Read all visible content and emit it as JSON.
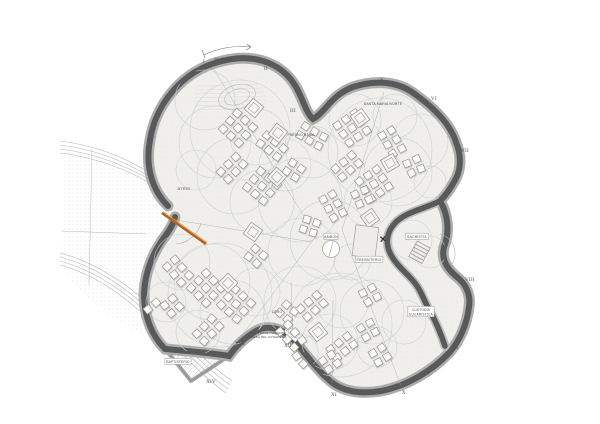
{
  "drawing": {
    "type": "architectural-floor-plan",
    "description": "Clover-shaped church / assembly hall plan with Via Crucis stations I-XIV around the perimeter",
    "colors": {
      "wall": "#58595b",
      "halo": "#adadab",
      "interior": "#f0efeb",
      "zone_circle": "#c9d0d6",
      "thin_line": "#a7afb5",
      "chair_fill": "#fbfaf7",
      "chair_stroke": "#96968e",
      "ramp": "#b5601a",
      "text": "#4a4a4a",
      "plaza_line": "#b5b5b2",
      "stipple": "#c9c8c3",
      "hatch": "#c6c5c1"
    }
  },
  "annotations": {
    "via_crucis": "VIA CRUCIS"
  },
  "stations": [
    {
      "label": "I",
      "x": 204,
      "y": 63
    },
    {
      "label": "II",
      "x": 266,
      "y": 70
    },
    {
      "label": "III",
      "x": 293,
      "y": 112
    },
    {
      "label": "IV",
      "x": 330,
      "y": 104
    },
    {
      "label": "V",
      "x": 382,
      "y": 81
    },
    {
      "label": "VI",
      "x": 434,
      "y": 100
    },
    {
      "label": "VII",
      "x": 465,
      "y": 152
    },
    {
      "label": "VIII",
      "x": 470,
      "y": 281
    },
    {
      "label": "IX",
      "x": 456,
      "y": 349
    },
    {
      "label": "X",
      "x": 404,
      "y": 394
    },
    {
      "label": "XI",
      "x": 334,
      "y": 396
    },
    {
      "label": "XII",
      "x": 288,
      "y": 347
    },
    {
      "label": "XIII",
      "x": 240,
      "y": 345
    },
    {
      "label": "XIV",
      "x": 211,
      "y": 383
    }
  ],
  "rooms": [
    {
      "id": "atrio",
      "lines": [
        "ATRIO"
      ],
      "x": 184,
      "y": 190,
      "boxed": false,
      "anchor": "middle",
      "size": 4
    },
    {
      "id": "fresno-rama",
      "lines": [
        "FRESNO RAMA"
      ],
      "x": 301,
      "y": 136,
      "boxed": false,
      "anchor": "middle",
      "size": 3.4
    },
    {
      "id": "santa-maria-norte",
      "lines": [
        "SANTA MARIA NORTE"
      ],
      "x": 383,
      "y": 105,
      "boxed": false,
      "anchor": "middle",
      "size": 3.4
    },
    {
      "id": "ambon",
      "lines": [
        "AMBON"
      ],
      "x": 331,
      "y": 238,
      "boxed": true,
      "anchor": "middle",
      "size": 3.4
    },
    {
      "id": "presbiterio",
      "lines": [
        "PRESBITERIO"
      ],
      "x": 369,
      "y": 261,
      "boxed": true,
      "anchor": "middle",
      "size": 3.4
    },
    {
      "id": "sacristia",
      "lines": [
        "SACRISTIA"
      ],
      "x": 417,
      "y": 238,
      "boxed": true,
      "anchor": "middle",
      "size": 3.4
    },
    {
      "id": "custodia-eucaristica",
      "lines": [
        "CUSTODIA",
        "EUCARISTICA"
      ],
      "x": 421,
      "y": 311,
      "boxed": true,
      "anchor": "middle",
      "size": 3.2
    },
    {
      "id": "coro",
      "lines": [
        "CORO"
      ],
      "x": 277,
      "y": 313,
      "boxed": false,
      "anchor": "middle",
      "size": 3.2
    },
    {
      "id": "baptisterio",
      "lines": [
        "BAPTISTERIO"
      ],
      "x": 178,
      "y": 363,
      "boxed": true,
      "anchor": "middle",
      "size": 3.2
    },
    {
      "id": "sala-mesa",
      "lines": [
        "SALA NAVE PONIENTE",
        "MESA DEL CONGRESO"
      ],
      "x": 251,
      "y": 334,
      "boxed": false,
      "anchor": "start",
      "size": 2.9
    }
  ],
  "plan": {
    "chair_size": 7,
    "chair_spacing": 10.5,
    "chair_clusters": [
      [
        238,
        128,
        3,
        3,
        42
      ],
      [
        272,
        146,
        3,
        2,
        38
      ],
      [
        232,
        168,
        2,
        3,
        45
      ],
      [
        262,
        186,
        3,
        3,
        40
      ],
      [
        294,
        170,
        2,
        2,
        35
      ],
      [
        312,
        136,
        3,
        2,
        30
      ],
      [
        352,
        128,
        3,
        3,
        -35
      ],
      [
        392,
        142,
        2,
        3,
        -30
      ],
      [
        347,
        166,
        3,
        2,
        -40
      ],
      [
        374,
        184,
        3,
        3,
        -35
      ],
      [
        414,
        166,
        2,
        2,
        -25
      ],
      [
        333,
        206,
        2,
        3,
        -30
      ],
      [
        362,
        197,
        2,
        2,
        -25
      ],
      [
        310,
        226,
        2,
        2,
        20
      ],
      [
        178,
        271,
        3,
        2,
        48
      ],
      [
        206,
        288,
        3,
        3,
        45
      ],
      [
        172,
        306,
        2,
        2,
        50
      ],
      [
        236,
        304,
        3,
        3,
        42
      ],
      [
        208,
        330,
        2,
        3,
        45
      ],
      [
        256,
        256,
        2,
        2,
        40
      ],
      [
        287,
        312,
        2,
        2,
        40
      ],
      [
        152,
        306,
        1,
        2,
        50
      ],
      [
        312,
        306,
        3,
        2,
        -40
      ],
      [
        370,
        295,
        2,
        2,
        -30
      ],
      [
        291,
        336,
        2,
        3,
        -42
      ],
      [
        342,
        347,
        3,
        2,
        -38
      ],
      [
        330,
        362,
        2,
        2,
        -35
      ],
      [
        368,
        330,
        2,
        2,
        -30
      ],
      [
        300,
        360,
        1,
        2,
        -40
      ],
      [
        380,
        355,
        2,
        2,
        -32
      ]
    ],
    "pavilions": [
      [
        254,
        108,
        40
      ],
      [
        278,
        133,
        38
      ],
      [
        277,
        177,
        42
      ],
      [
        360,
        118,
        -35
      ],
      [
        390,
        163,
        -30
      ],
      [
        370,
        218,
        -35
      ],
      [
        253,
        232,
        35
      ],
      [
        228,
        283,
        45
      ],
      [
        318,
        332,
        -38
      ]
    ],
    "circles": [
      [
        240,
        130,
        50
      ],
      [
        380,
        150,
        52
      ],
      [
        220,
        295,
        52
      ],
      [
        340,
        325,
        52
      ],
      [
        330,
        240,
        40
      ],
      [
        205,
        100,
        30
      ],
      [
        215,
        142,
        36
      ],
      [
        258,
        137,
        28
      ],
      [
        235,
        176,
        38
      ],
      [
        285,
        165,
        26
      ],
      [
        196,
        170,
        20
      ],
      [
        262,
        202,
        32
      ],
      [
        300,
        200,
        42
      ],
      [
        312,
        152,
        26
      ],
      [
        355,
        120,
        26
      ],
      [
        395,
        116,
        22
      ],
      [
        420,
        142,
        28
      ],
      [
        398,
        172,
        34
      ],
      [
        430,
        182,
        16
      ],
      [
        368,
        202,
        24
      ],
      [
        302,
        252,
        34
      ],
      [
        352,
        262,
        18
      ],
      [
        182,
        262,
        28
      ],
      [
        212,
        282,
        38
      ],
      [
        166,
        302,
        20
      ],
      [
        232,
        312,
        32
      ],
      [
        198,
        332,
        22
      ],
      [
        256,
        292,
        24
      ],
      [
        300,
        302,
        36
      ],
      [
        342,
        302,
        26
      ],
      [
        372,
        312,
        32
      ],
      [
        330,
        342,
        28
      ],
      [
        377,
        347,
        20
      ],
      [
        300,
        352,
        18
      ],
      [
        404,
        322,
        22
      ],
      [
        430,
        252,
        16
      ],
      [
        412,
        240,
        20
      ]
    ],
    "lines": [
      [
        213,
        68,
        316,
        236
      ],
      [
        316,
        236,
        240,
        338
      ],
      [
        384,
        92,
        342,
        230
      ],
      [
        342,
        230,
        401,
        386
      ],
      [
        176,
        220,
        312,
        242
      ],
      [
        333,
        300,
        332,
        389
      ],
      [
        291,
        282,
        293,
        334
      ]
    ]
  }
}
